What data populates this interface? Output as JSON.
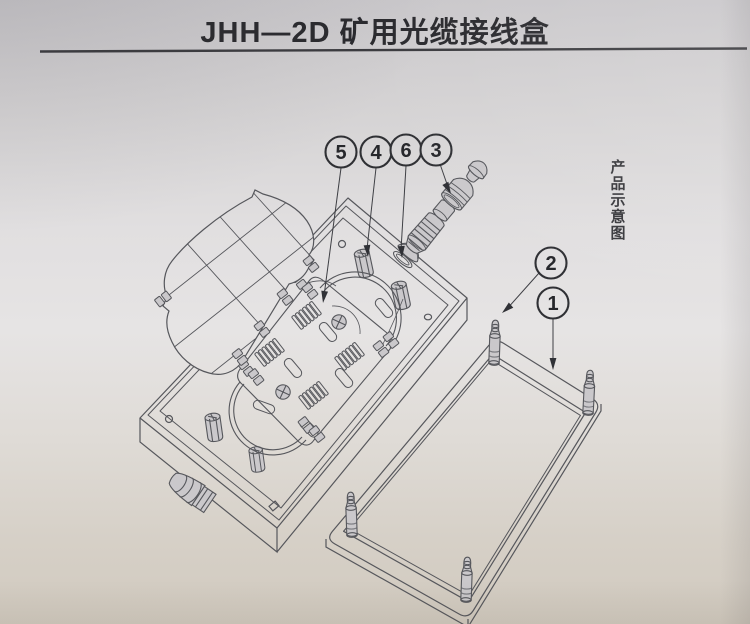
{
  "title": "JHH—2D 矿用光缆接线盒",
  "side_caption": "产品示意图",
  "callouts": {
    "n1": {
      "label": "1"
    },
    "n2": {
      "label": "2"
    },
    "n3": {
      "label": "3"
    },
    "n4": {
      "label": "4"
    },
    "n5": {
      "label": "5"
    },
    "n6": {
      "label": "6"
    }
  },
  "colors": {
    "paper_top": "#cac8cb",
    "paper_mid": "#e6e4e4",
    "paper_bottom": "#d1cabf",
    "line_ink": "#56575c",
    "callout_ink": "#2f3034",
    "text_ink": "#2a2a2e"
  }
}
